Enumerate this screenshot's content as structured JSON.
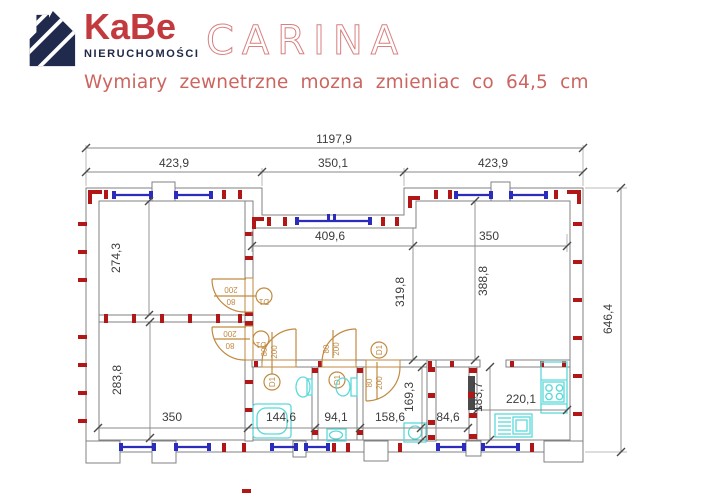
{
  "header": {
    "logo": {
      "brand": "KaBe",
      "tagline": "NIERUCHOMOŚCI",
      "icon": "striped-house-icon",
      "brand_color": "#c23a3e",
      "tagline_color": "#20284a",
      "icon_color": "#1f2a4d"
    },
    "title": "CARINA",
    "title_color": "#d98080",
    "subtitle": "Wymiary zewnetrzne mozna zmieniac co 64,5 cm",
    "subtitle_color": "#cc6460"
  },
  "floorplan": {
    "unit": "cm",
    "dimensions": {
      "total_width": "1197,9",
      "top_left": "423,9",
      "top_middle": "350,1",
      "top_right": "423,9",
      "room_top_left_height": "274,3",
      "room_bottom_left_height": "283,8",
      "hall_width": "409,6",
      "hall_height": "319,8",
      "living_width": "350",
      "living_height": "388,8",
      "total_height": "646,4",
      "bottom_1": "350",
      "bottom_2": "144,6",
      "bottom_3": "94,1",
      "bottom_4": "158,6",
      "bottom_5": "84,6",
      "corridor_height": "169,3",
      "kitchen_width": "220,1",
      "kitchen_height": "183,7"
    },
    "door": {
      "label": "D1",
      "width": "80",
      "height": "200"
    },
    "colors": {
      "walls": "#818181",
      "dimension_text": "#3c3c3c",
      "brick_marks": "#b11717",
      "windows": "#2c2cbc",
      "doors": "#c08a42",
      "fixtures": "#5cd9d9",
      "flue": "#4a4a4a"
    },
    "fixtures": [
      "bathtub",
      "washbasin",
      "toilet",
      "washing-machine",
      "kitchen-sink",
      "stove",
      "kitchen-counter",
      "flue"
    ]
  }
}
